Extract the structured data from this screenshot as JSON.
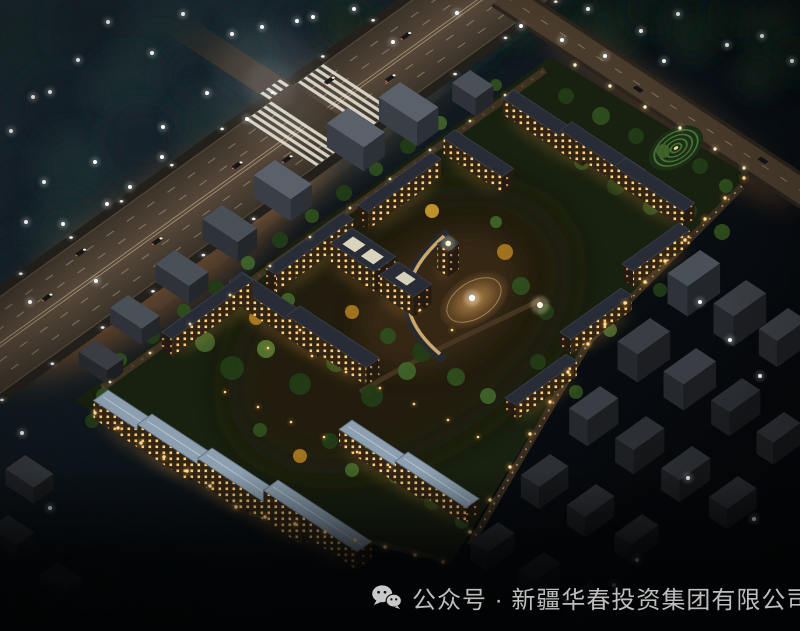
{
  "caption": {
    "icon": "wechat-icon",
    "text": "公众号 · 新疆华春投资集团有限公司"
  },
  "palette": {
    "sky_top_left": "#22333c",
    "sky_bottom": "#05070a",
    "road_glow": "#ff8f35",
    "warm_trail": "#ffb866",
    "white_trail": "#fff1cf",
    "lit_window": "#ffd080",
    "blue_roof": "#8da0b1",
    "dark_roof": "#272c36",
    "tree_green": "#2f4f1e",
    "autumn_tree": "#c9992e",
    "caption_text": "#bdbdbd",
    "lamp_warm": "#ffdf9d"
  },
  "scene": {
    "description": "night aerial rendering of a lit residential compound surrounded by dark city blocks, highway with light trails at upper left, landscaped central plaza",
    "whiteLights": [
      [
        183,
        14
      ],
      [
        108,
        22
      ],
      [
        232,
        34
      ],
      [
        262,
        27
      ],
      [
        297,
        21
      ],
      [
        152,
        53
      ],
      [
        207,
        93
      ],
      [
        247,
        119
      ],
      [
        163,
        127
      ],
      [
        50,
        92
      ],
      [
        95,
        162
      ],
      [
        162,
        157
      ],
      [
        44,
        182
      ],
      [
        107,
        204
      ],
      [
        26,
        222
      ],
      [
        63,
        224
      ],
      [
        313,
        17
      ],
      [
        354,
        9
      ],
      [
        393,
        42
      ],
      [
        457,
        13
      ],
      [
        521,
        26
      ],
      [
        562,
        40
      ],
      [
        588,
        9
      ],
      [
        641,
        31
      ],
      [
        678,
        14
      ],
      [
        727,
        45
      ],
      [
        762,
        36
      ],
      [
        792,
        61
      ],
      [
        664,
        61
      ],
      [
        605,
        56
      ],
      [
        11,
        131
      ],
      [
        33,
        97
      ],
      [
        78,
        60
      ],
      [
        130,
        187
      ],
      [
        96,
        281
      ],
      [
        30,
        302
      ],
      [
        700,
        302
      ],
      [
        730,
        340
      ],
      [
        760,
        376
      ],
      [
        688,
        478
      ],
      [
        754,
        519
      ],
      [
        637,
        560
      ],
      [
        566,
        601
      ],
      [
        614,
        585
      ],
      [
        22,
        433
      ],
      [
        50,
        508
      ]
    ],
    "perimeterLamps": [
      [
        95,
        413
      ],
      [
        118,
        428
      ],
      [
        141,
        443
      ],
      [
        164,
        457
      ],
      [
        187,
        471
      ],
      [
        210,
        486
      ],
      [
        236,
        507
      ],
      [
        265,
        517
      ],
      [
        295,
        524
      ],
      [
        325,
        532
      ],
      [
        355,
        540
      ],
      [
        385,
        547
      ],
      [
        415,
        555
      ],
      [
        443,
        562
      ],
      [
        470,
        532
      ],
      [
        490,
        500
      ],
      [
        510,
        467
      ],
      [
        530,
        434
      ],
      [
        550,
        402
      ],
      [
        568,
        372
      ],
      [
        588,
        344
      ],
      [
        605,
        324
      ],
      [
        625,
        303
      ],
      [
        645,
        282
      ],
      [
        665,
        261
      ],
      [
        685,
        240
      ],
      [
        705,
        219
      ],
      [
        725,
        198
      ],
      [
        744,
        178
      ]
    ],
    "fenceLamps": [
      [
        110,
        382
      ],
      [
        150,
        353
      ],
      [
        190,
        324
      ],
      [
        230,
        295
      ],
      [
        270,
        266
      ],
      [
        310,
        237
      ],
      [
        350,
        208
      ],
      [
        390,
        179
      ],
      [
        430,
        150
      ],
      [
        470,
        121
      ],
      [
        505,
        95
      ]
    ],
    "streetLamps": [
      [
        575,
        65
      ],
      [
        610,
        86
      ],
      [
        645,
        107
      ],
      [
        680,
        128
      ],
      [
        715,
        149
      ],
      [
        744,
        168
      ]
    ],
    "gardenLamps": [
      [
        225,
        392
      ],
      [
        258,
        407
      ],
      [
        291,
        422
      ],
      [
        324,
        437
      ],
      [
        357,
        452
      ],
      [
        390,
        467
      ],
      [
        312,
        356
      ],
      [
        346,
        372
      ],
      [
        380,
        388
      ],
      [
        414,
        404
      ],
      [
        448,
        420
      ],
      [
        478,
        437
      ],
      [
        420,
        310
      ],
      [
        452,
        330
      ],
      [
        300,
        330
      ],
      [
        268,
        348
      ]
    ],
    "canopy": [
      [
        30,
        45,
        40,
        "#1b2d33"
      ],
      [
        95,
        28,
        45,
        "#14232a"
      ],
      [
        160,
        48,
        42,
        "#1b2d33"
      ],
      [
        60,
        112,
        44,
        "#14232a"
      ],
      [
        128,
        92,
        40,
        "#1b2d33"
      ],
      [
        198,
        78,
        38,
        "#14232a"
      ],
      [
        255,
        52,
        36,
        "#1b2d33"
      ],
      [
        305,
        28,
        34,
        "#14232a"
      ],
      [
        25,
        195,
        42,
        "#14232a"
      ],
      [
        75,
        168,
        40,
        "#1b2d33"
      ],
      [
        142,
        140,
        38,
        "#14232a"
      ],
      [
        205,
        122,
        32,
        "#1b2d33"
      ],
      [
        18,
        268,
        36,
        "#14232a"
      ],
      [
        62,
        232,
        34,
        "#1b2d33"
      ],
      [
        345,
        22,
        26,
        "#15261b"
      ],
      [
        392,
        38,
        26,
        "#0e1d13"
      ],
      [
        436,
        16,
        24,
        "#15261b"
      ],
      [
        478,
        40,
        24,
        "#0e1d13"
      ],
      [
        515,
        22,
        22,
        "#15261b"
      ],
      [
        575,
        12,
        26,
        "#0e1d13"
      ],
      [
        612,
        28,
        28,
        "#15261b"
      ],
      [
        652,
        10,
        26,
        "#0e1d13"
      ],
      [
        692,
        32,
        28,
        "#15261b"
      ],
      [
        732,
        14,
        26,
        "#0e1d13"
      ],
      [
        772,
        30,
        28,
        "#15261b"
      ],
      [
        796,
        58,
        24,
        "#0e1d13"
      ],
      [
        758,
        74,
        22,
        "#15261b"
      ],
      [
        95,
        585,
        30,
        "#0c150d"
      ],
      [
        170,
        600,
        26,
        "#0a120c"
      ],
      [
        30,
        595,
        26,
        "#0a120c"
      ]
    ],
    "trees": [
      [
        120,
        360,
        7,
        "#2f4f1e"
      ],
      [
        152,
        336,
        8,
        "#223c17"
      ],
      [
        184,
        311,
        7,
        "#2f4f1e"
      ],
      [
        216,
        288,
        8,
        "#223c17"
      ],
      [
        248,
        263,
        7,
        "#41642a"
      ],
      [
        280,
        240,
        8,
        "#223c17"
      ],
      [
        312,
        216,
        7,
        "#2f4f1e"
      ],
      [
        344,
        193,
        8,
        "#223c17"
      ],
      [
        376,
        169,
        7,
        "#2f4f1e"
      ],
      [
        408,
        146,
        8,
        "#223c17"
      ],
      [
        440,
        123,
        7,
        "#41642a"
      ],
      [
        468,
        103,
        7,
        "#223c17"
      ],
      [
        496,
        85,
        6,
        "#2f4f1e"
      ],
      [
        205,
        342,
        10,
        "#41642a"
      ],
      [
        232,
        368,
        12,
        "#223c17"
      ],
      [
        266,
        349,
        9,
        "#567a33"
      ],
      [
        300,
        384,
        11,
        "#223c17"
      ],
      [
        336,
        362,
        10,
        "#2f4f1e"
      ],
      [
        372,
        396,
        11,
        "#223c17"
      ],
      [
        407,
        371,
        9,
        "#41642a"
      ],
      [
        322,
        332,
        8,
        "#c9992e"
      ],
      [
        352,
        312,
        7,
        "#a9771f"
      ],
      [
        388,
        336,
        8,
        "#2f4f1e"
      ],
      [
        422,
        352,
        10,
        "#223c17"
      ],
      [
        456,
        377,
        9,
        "#2f4f1e"
      ],
      [
        488,
        396,
        8,
        "#41642a"
      ],
      [
        256,
        318,
        7,
        "#a9771f"
      ],
      [
        288,
        300,
        7,
        "#41642a"
      ],
      [
        432,
        211,
        7,
        "#c9992e"
      ],
      [
        505,
        252,
        8,
        "#a9771f"
      ],
      [
        521,
        286,
        9,
        "#2f4f1e"
      ],
      [
        546,
        312,
        8,
        "#223c17"
      ],
      [
        496,
        222,
        6,
        "#41642a"
      ],
      [
        566,
        96,
        8,
        "#223c17"
      ],
      [
        601,
        116,
        9,
        "#2f4f1e"
      ],
      [
        636,
        136,
        8,
        "#223c17"
      ],
      [
        663,
        151,
        7,
        "#41642a"
      ],
      [
        700,
        166,
        8,
        "#223c17"
      ],
      [
        726,
        186,
        7,
        "#2f4f1e"
      ],
      [
        582,
        162,
        8,
        "#2f4f1e"
      ],
      [
        616,
        186,
        9,
        "#223c17"
      ],
      [
        651,
        207,
        8,
        "#2f4f1e"
      ],
      [
        548,
        131,
        7,
        "#a9771f"
      ],
      [
        688,
        211,
        9,
        "#223c17"
      ],
      [
        722,
        232,
        8,
        "#2f4f1e"
      ],
      [
        330,
        441,
        8,
        "#223c17"
      ],
      [
        396,
        476,
        8,
        "#2f4f1e"
      ],
      [
        300,
        456,
        7,
        "#a9771f"
      ],
      [
        432,
        502,
        8,
        "#223c17"
      ],
      [
        462,
        522,
        7,
        "#2f4f1e"
      ],
      [
        352,
        470,
        7,
        "#41642a"
      ],
      [
        260,
        430,
        7,
        "#2f4f1e"
      ],
      [
        104,
        396,
        8,
        "#2f4f1e"
      ],
      [
        92,
        421,
        7,
        "#223c17"
      ],
      [
        538,
        362,
        8,
        "#223c17"
      ],
      [
        576,
        392,
        7,
        "#2f4f1e"
      ],
      [
        610,
        330,
        7,
        "#41642a"
      ],
      [
        660,
        290,
        7,
        "#223c17"
      ]
    ],
    "grayBuildings": [
      [
        348,
        108,
        26,
        44,
        24,
        "light"
      ],
      [
        275,
        160,
        26,
        44,
        22,
        "light"
      ],
      [
        222,
        205,
        24,
        42,
        20,
        "mid"
      ],
      [
        400,
        82,
        26,
        46,
        24,
        "light"
      ],
      [
        470,
        70,
        22,
        28,
        18,
        "mid"
      ],
      [
        175,
        250,
        24,
        40,
        18,
        "mid"
      ],
      [
        128,
        295,
        22,
        38,
        16,
        "mid"
      ],
      [
        95,
        340,
        20,
        34,
        14,
        "dim"
      ],
      [
        25,
        455,
        24,
        34,
        16,
        "dim"
      ],
      [
        8,
        515,
        22,
        32,
        14,
        "dark"
      ],
      [
        58,
        562,
        22,
        30,
        12,
        "dark"
      ],
      [
        700,
        250,
        40,
        24,
        30,
        "mid"
      ],
      [
        746,
        280,
        40,
        24,
        30,
        "dim"
      ],
      [
        650,
        318,
        40,
        24,
        28,
        "dim"
      ],
      [
        696,
        348,
        40,
        24,
        26,
        "dim"
      ],
      [
        742,
        378,
        38,
        22,
        24,
        "dark"
      ],
      [
        600,
        386,
        38,
        22,
        26,
        "dim"
      ],
      [
        646,
        416,
        38,
        22,
        24,
        "dark"
      ],
      [
        692,
        446,
        38,
        22,
        22,
        "dark"
      ],
      [
        738,
        476,
        36,
        22,
        20,
        "dark"
      ],
      [
        550,
        454,
        36,
        22,
        22,
        "dark"
      ],
      [
        596,
        484,
        36,
        22,
        20,
        "dark"
      ],
      [
        642,
        514,
        34,
        20,
        18,
        "dark"
      ],
      [
        498,
        522,
        34,
        20,
        18,
        "dark"
      ],
      [
        544,
        552,
        32,
        20,
        16,
        "dark"
      ],
      [
        590,
        582,
        30,
        18,
        14,
        "dark"
      ],
      [
        788,
        308,
        36,
        22,
        26,
        "dim"
      ],
      [
        784,
        412,
        34,
        20,
        22,
        "dark"
      ]
    ],
    "litBuildings": [
      [
        455,
        130,
        14,
        70,
        16,
        "dark",
        "v"
      ],
      [
        514,
        90,
        14,
        95,
        16,
        "dark",
        "v"
      ],
      [
        572,
        122,
        14,
        88,
        16,
        "dark",
        "v"
      ],
      [
        626,
        158,
        14,
        82,
        16,
        "dark",
        "v"
      ],
      [
        242,
        272,
        16,
        105,
        18,
        "dark",
        "v"
      ],
      [
        300,
        306,
        16,
        95,
        18,
        "dark",
        "v"
      ],
      [
        108,
        390,
        18,
        115,
        18,
        "blue",
        "v"
      ],
      [
        152,
        414,
        18,
        130,
        18,
        "blue",
        "v"
      ],
      [
        212,
        448,
        18,
        125,
        18,
        "blue",
        "v"
      ],
      [
        278,
        480,
        18,
        112,
        18,
        "blue",
        "v"
      ],
      [
        352,
        420,
        16,
        100,
        16,
        "blue",
        "v"
      ],
      [
        408,
        452,
        16,
        85,
        16,
        "blue",
        "v"
      ],
      [
        162,
        332,
        12,
        100,
        18,
        "dark",
        "u"
      ],
      [
        266,
        268,
        12,
        95,
        18,
        "dark",
        "u"
      ],
      [
        358,
        205,
        12,
        90,
        18,
        "dark",
        "u"
      ],
      [
        505,
        398,
        13,
        75,
        15,
        "dark",
        "u"
      ],
      [
        560,
        332,
        13,
        75,
        15,
        "dark",
        "u"
      ],
      [
        622,
        264,
        13,
        70,
        15,
        "dark",
        "u"
      ],
      [
        352,
        228,
        26,
        52,
        20,
        "dark",
        "v"
      ],
      [
        398,
        262,
        22,
        40,
        20,
        "dark",
        "v"
      ],
      [
        448,
        236,
        13,
        13,
        26,
        "dark",
        "v"
      ]
    ],
    "highwayCars": [
      [
        20,
        -26
      ],
      [
        70,
        -12
      ],
      [
        130,
        -30
      ],
      [
        185,
        8
      ],
      [
        235,
        24
      ],
      [
        300,
        -8
      ],
      [
        335,
        18
      ],
      [
        430,
        -24
      ],
      [
        468,
        12
      ],
      [
        515,
        -15
      ],
      [
        -55,
        14
      ],
      [
        -25,
        -22
      ]
    ]
  }
}
